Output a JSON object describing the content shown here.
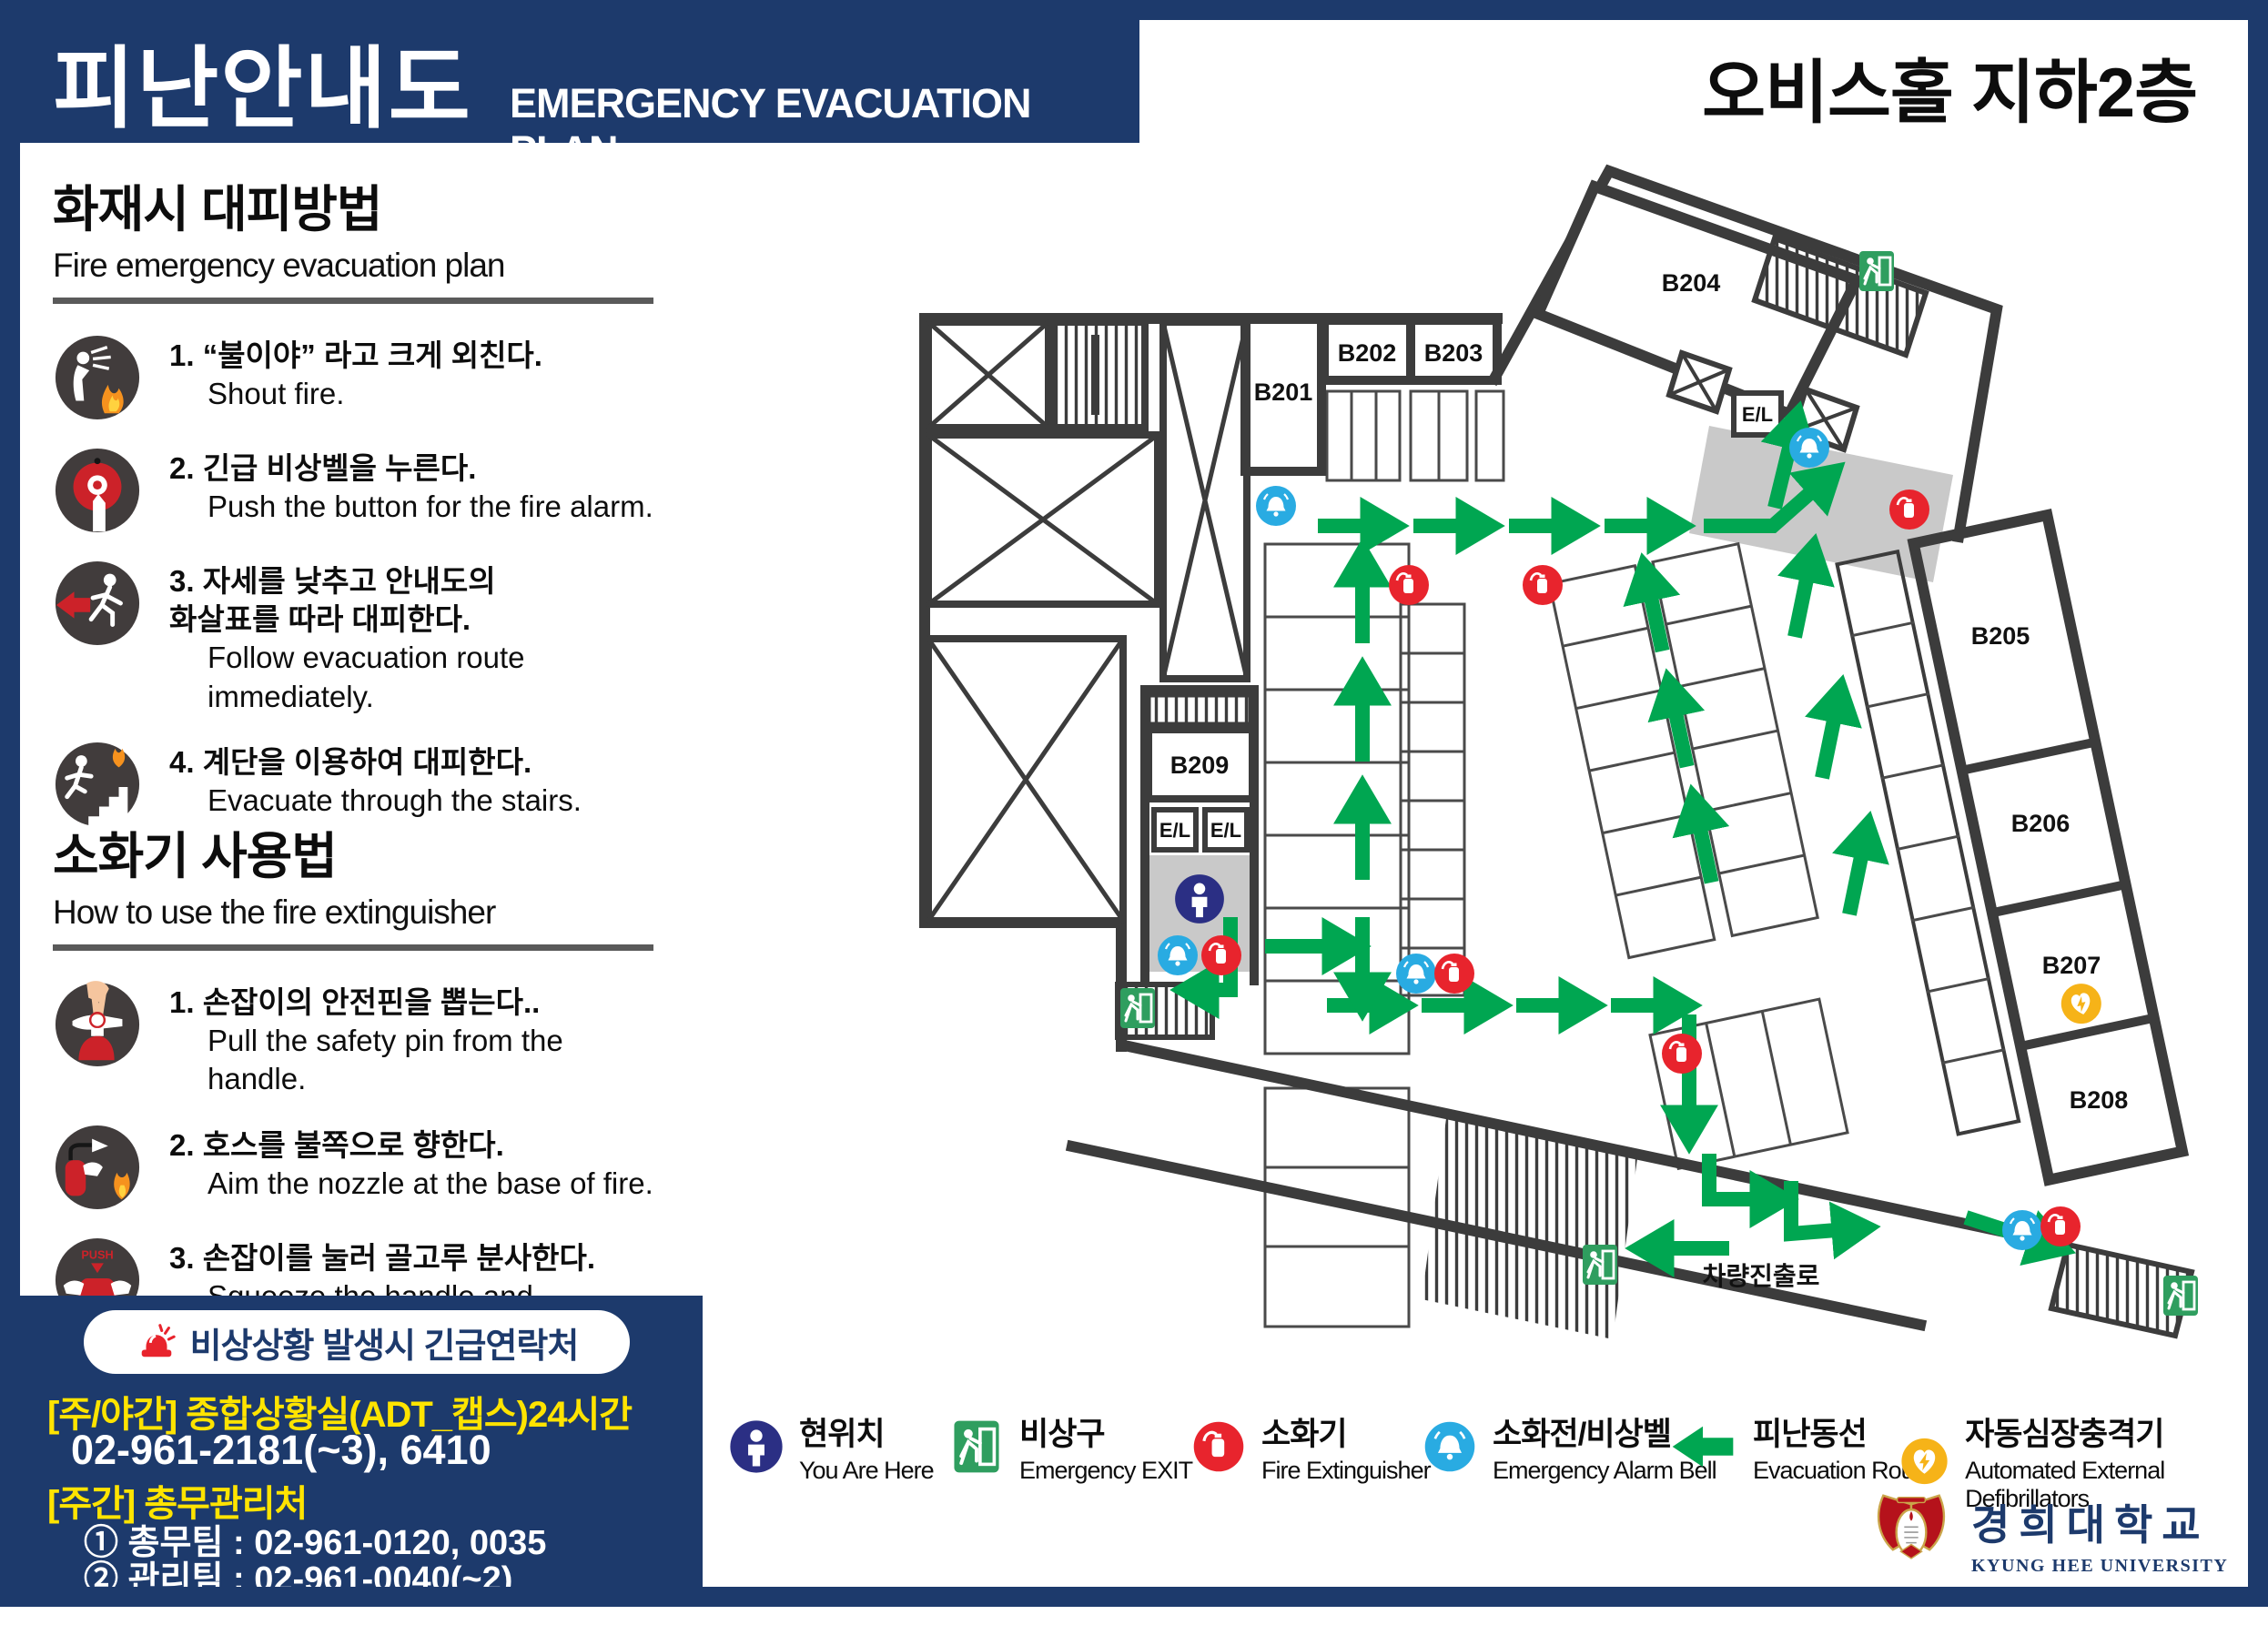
{
  "colors": {
    "navy": "#1d3a6c",
    "route_green": "#00a651",
    "exit_green": "#2f9e5f",
    "extinguisher_red": "#e8242d",
    "alarm_cyan": "#29abe2",
    "aed_yellow": "#f6b318",
    "contact_yellow": "#ffe400",
    "wall_gray": "#3c3c3c",
    "lobby_gray": "#c9c9c9"
  },
  "header": {
    "title_ko": "피난안내도",
    "title_en": "EMERGENCY EVACUATION PLAN",
    "location_title": "오비스홀 지하2층"
  },
  "fire_section": {
    "title": "화재시 대피방법",
    "subtitle": "Fire emergency evacuation plan",
    "steps": [
      {
        "ko": "1. “불이야” 라고 크게 외친다.",
        "en": "Shout fire."
      },
      {
        "ko": "2. 긴급 비상벨을 누른다.",
        "en": "Push the button for the fire alarm."
      },
      {
        "ko": "3. 자세를 낮추고 안내도의\n화살표를 따라 대피한다.",
        "en": "Follow evacuation route immediately."
      },
      {
        "ko": "4. 계단을 이용하여 대피한다.",
        "en": "Evacuate through the stairs."
      }
    ]
  },
  "extinguisher_section": {
    "title": "소화기 사용법",
    "subtitle": "How to use the fire extinguisher",
    "steps": [
      {
        "ko": "1. 손잡이의 안전핀을 뽑는다..",
        "en": "Pull the safety pin from the handle."
      },
      {
        "ko": "2. 호스를 불쪽으로 향한다.",
        "en": "Aim the nozzle at the base of fire."
      },
      {
        "ko": "3. 손잡이를 눌러 골고루 분사한다.",
        "en": "Squeeze the handle and\nsweep the nozzle from side to side."
      }
    ]
  },
  "contact": {
    "banner": "비상상황 발생시 긴급연락처",
    "line_day_night": "[주/야간] 종합상황실(ADT_캡스)24시간",
    "phone_main": "02-961-2181(~3), 6410",
    "line_day": "[주간] 총무관리처",
    "teams": [
      "① 총무팀 : 02-961-0120, 0035",
      "② 관리팀 : 02-961-0040(~2)",
      "③ 안전팀 : 02-961-0119"
    ]
  },
  "legend": {
    "items": [
      {
        "ko": "현위치",
        "en": "You Are Here",
        "icon": "you-are-here"
      },
      {
        "ko": "비상구",
        "en": "Emergency EXIT",
        "icon": "emergency-exit"
      },
      {
        "ko": "소화기",
        "en": "Fire Extinguisher",
        "icon": "fire-extinguisher"
      },
      {
        "ko": "소화전/비상벨",
        "en": "Emergency Alarm Bell",
        "icon": "alarm-bell"
      },
      {
        "ko": "피난동선",
        "en": "Evacuation Route",
        "icon": "evacuation-route"
      },
      {
        "ko": "자동심장충격기",
        "en": "Automated External Defibrillators",
        "icon": "aed"
      }
    ]
  },
  "floor_plan": {
    "rooms": [
      "B201",
      "B202",
      "B203",
      "B204",
      "B205",
      "B206",
      "B207",
      "B208",
      "B209"
    ],
    "elevator_label": "E/L",
    "ramp_label": "차량진출로"
  },
  "footer": {
    "university_ko": "경희대학교",
    "university_en": "KYUNG HEE UNIVERSITY"
  }
}
